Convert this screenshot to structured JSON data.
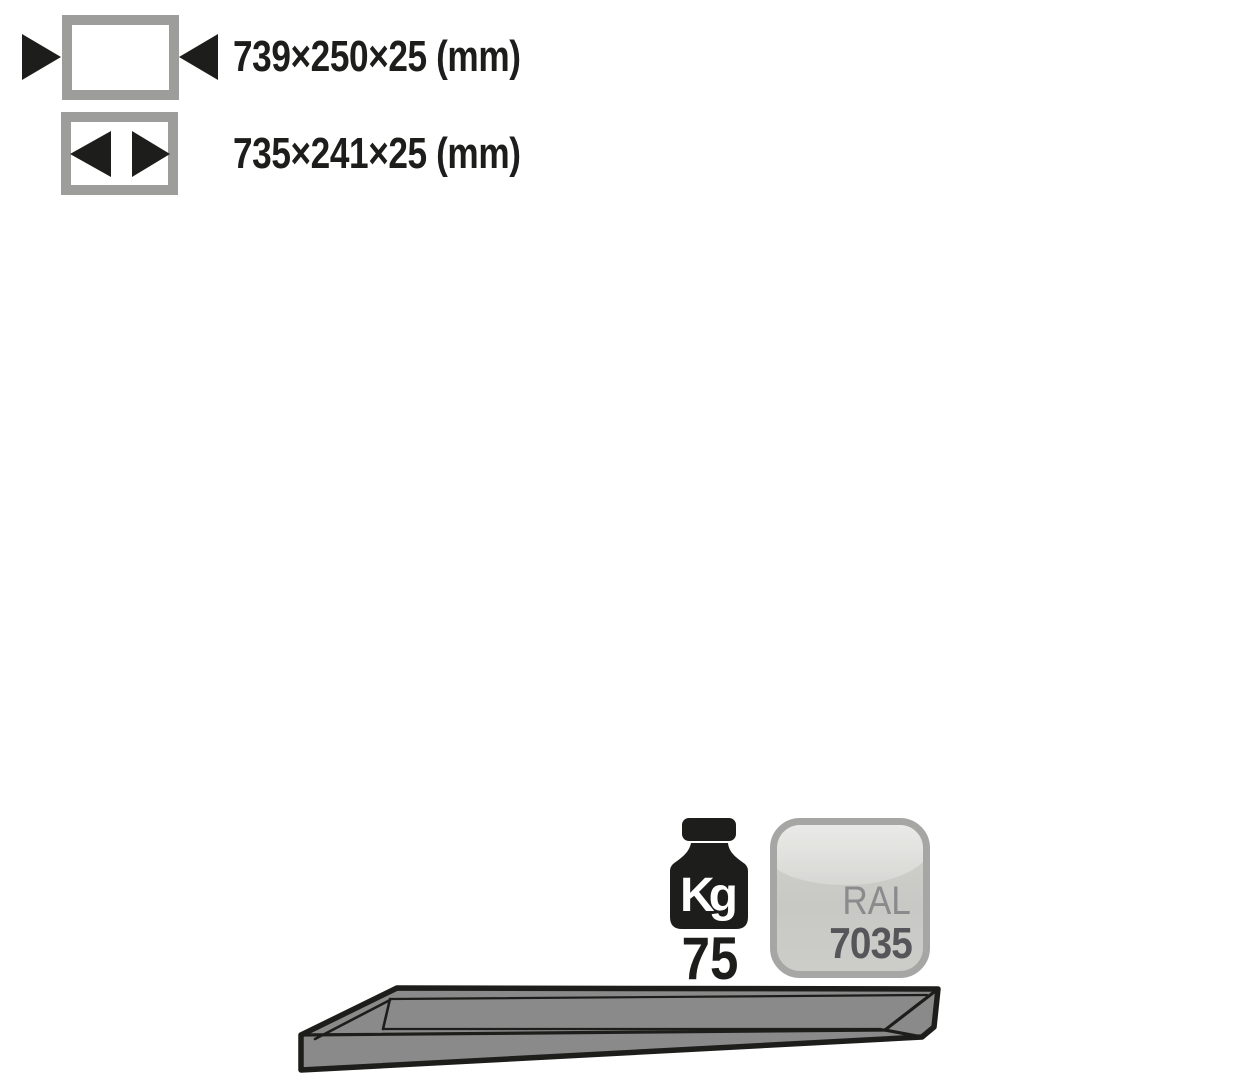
{
  "spec_sheet": {
    "external_dimensions": {
      "label": "739×250×25 (mm)"
    },
    "internal_dimensions": {
      "label": "735×241×25 (mm)"
    },
    "max_load": {
      "unit": "Kg",
      "value": "75"
    },
    "color": {
      "system": "RAL",
      "code": "7035"
    }
  },
  "colors": {
    "ink": "#1d1d1b",
    "pictogram_grey": "#9d9d9c",
    "tray_grey": "#8a8a8a",
    "ral_7035_hex": "#cbcbc6",
    "swatch_border": "#a6a6a5"
  }
}
